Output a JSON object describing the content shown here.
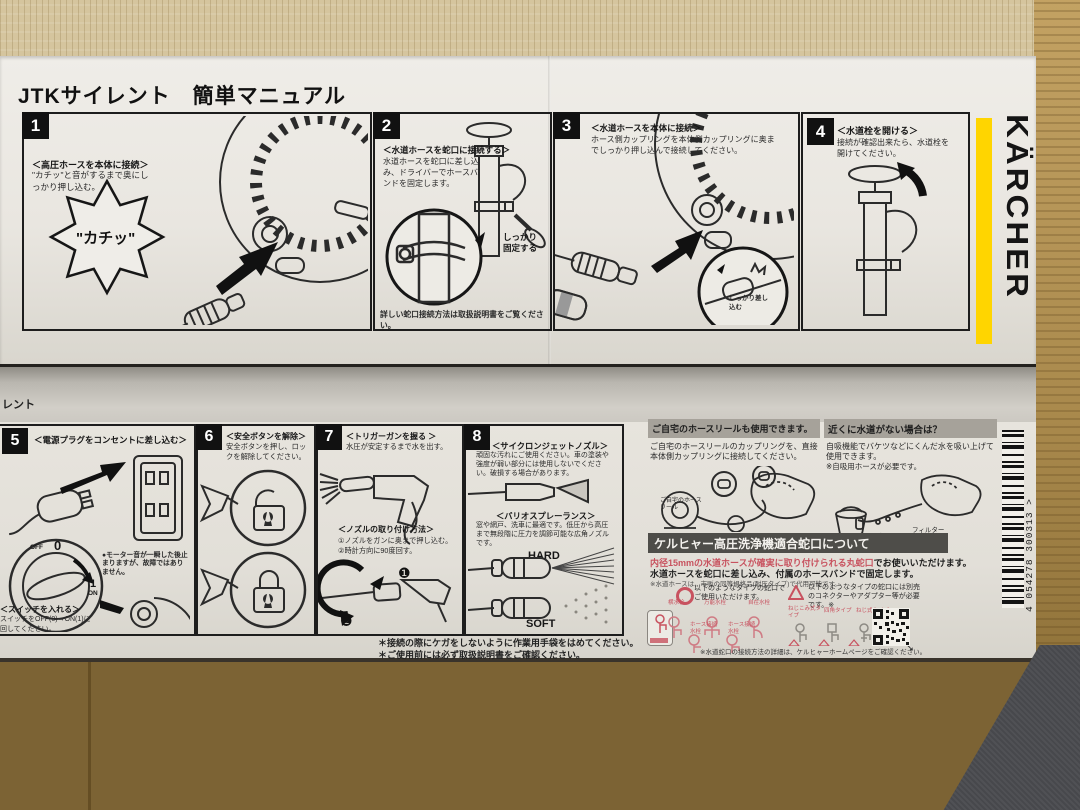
{
  "colors": {
    "karcher_yellow": "#FFD500",
    "accent_red": "#C8525F",
    "bar_gray": "#A6A29A",
    "bar_dark": "#4E4D49"
  },
  "brand": "KÄRCHER",
  "top": {
    "title": "JTKサイレント　簡単マニュアル",
    "step1": {
      "num": "1",
      "heading": "＜高圧ホースを本体に接続＞",
      "body": "\"カチッ\"と音がするまで奥にしっかり押し込む。",
      "callout": "\"カチッ\""
    },
    "step2": {
      "num": "2",
      "heading": "＜水道ホースを蛇口に接続する＞",
      "body": "水道ホースを蛇口に差し込み、ドライバーでホースバンドを固定します。",
      "note": "しっかり固定する",
      "footer": "詳しい蛇口接続方法は取扱説明書をご覧ください。"
    },
    "step3": {
      "num": "3",
      "heading": "＜水道ホースを本体に接続＞",
      "body": "ホース側カップリングを本体側カップリングに奥までしっかり押し込んで接続してください。",
      "note": "しっかり差し込む"
    },
    "step4": {
      "num": "4",
      "heading": "＜水道栓を開ける＞",
      "body": "接続が確認出来たら、水道栓を開けてください。"
    }
  },
  "bottom": {
    "edge_label": "レント",
    "step5": {
      "num": "5",
      "heading": "＜電源プラグをコンセントに差し込む＞",
      "dial": {
        "off": "OFF",
        "zero": "0",
        "one": "1",
        "on": "ON"
      },
      "note": "●モーター音が一瞬した後止まりますが、故障ではありません。",
      "sub_heading": "＜スイッチを入れる＞",
      "sub_body": "スイッチをOFF(0)→ON(1)に回してください。"
    },
    "step6": {
      "num": "6",
      "heading": "＜安全ボタンを解除＞",
      "body": "安全ボタンを押し、ロックを解除してください。"
    },
    "step7": {
      "num": "7",
      "heading": "＜トリガーガンを握る ＞",
      "body": "水圧が安定するまで水を出す。",
      "sub_heading": "＜ノズルの取り付け方法＞",
      "step_a": "①ノズルをガンに奥まで押し込む。",
      "step_b": "②時計方向に90度回す。",
      "marker1": "❶",
      "marker2": "❷"
    },
    "step8": {
      "num": "8",
      "heading1": "＜サイクロンジェットノズル＞",
      "body1": "頑固な汚れにご使用ください。車の塗装や強度が弱い部分には使用しないでください。破損する場合があります。",
      "heading2": "＜バリオスプレーランス＞",
      "body2": "窓や網戸、洗車に最適です。低圧から高圧まで無段階に圧力を調節可能な広角ノズルです。",
      "hard": "HARD",
      "soft": "SOFT"
    },
    "footnote1": "＊接続の際にケガをしないように作業用手袋をはめてください。",
    "footnote2": "＊ご使用前には必ず取扱説明書をご確認ください。",
    "hose_reel": {
      "header": "ご自宅のホースリールも使用できます。",
      "body": "ご自宅のホースリールのカップリングを、直接本体側カップリングに接続してください。",
      "label": "ご自宅のホースリール"
    },
    "no_water": {
      "header": "近くに水道がない場合は？",
      "body": "自吸機能でバケツなどにくんだ水を吸い上げて使用できます。",
      "note": "※自吸用ホースが必要です。",
      "label_hose": "自吸用ホース",
      "label_filter": "フィルター"
    },
    "faucet": {
      "header": "ケルヒャー高圧洗浄機適合蛇口について",
      "line1_hl": "内径15mmの水道ホースが確実に取り付けられる丸蛇口",
      "line1": "でお使いいただけます。",
      "line2": "水道ホースを蛇口に差し込み、付属のホースバンドで固定します。",
      "line3": "※水道ホースは、市販の同等規格品(耐圧タイプ)で代用可能です。",
      "ok_text": "以下のようなタイプの蛇口でご使用いただけます。",
      "ok1": "横水栓",
      "ok2": "万能水栓",
      "ok3": "自在水栓",
      "ok4": "ホース接続水栓",
      "ok5": "ホース接続水栓",
      "ng_text": "以下のようなタイプの蛇口には別売のコネクターやアダプター等が必要です。※",
      "ng1": "ねじこみ式タイプ",
      "ng2": "四角タイプ",
      "ng3": "ねじ式タイプ",
      "footer": "※水道蛇口の接続方法の詳細は、ケルヒャーホームページをご確認ください。",
      "footer_arrow": "➘"
    },
    "barcode": "4 054278 300313 >"
  }
}
